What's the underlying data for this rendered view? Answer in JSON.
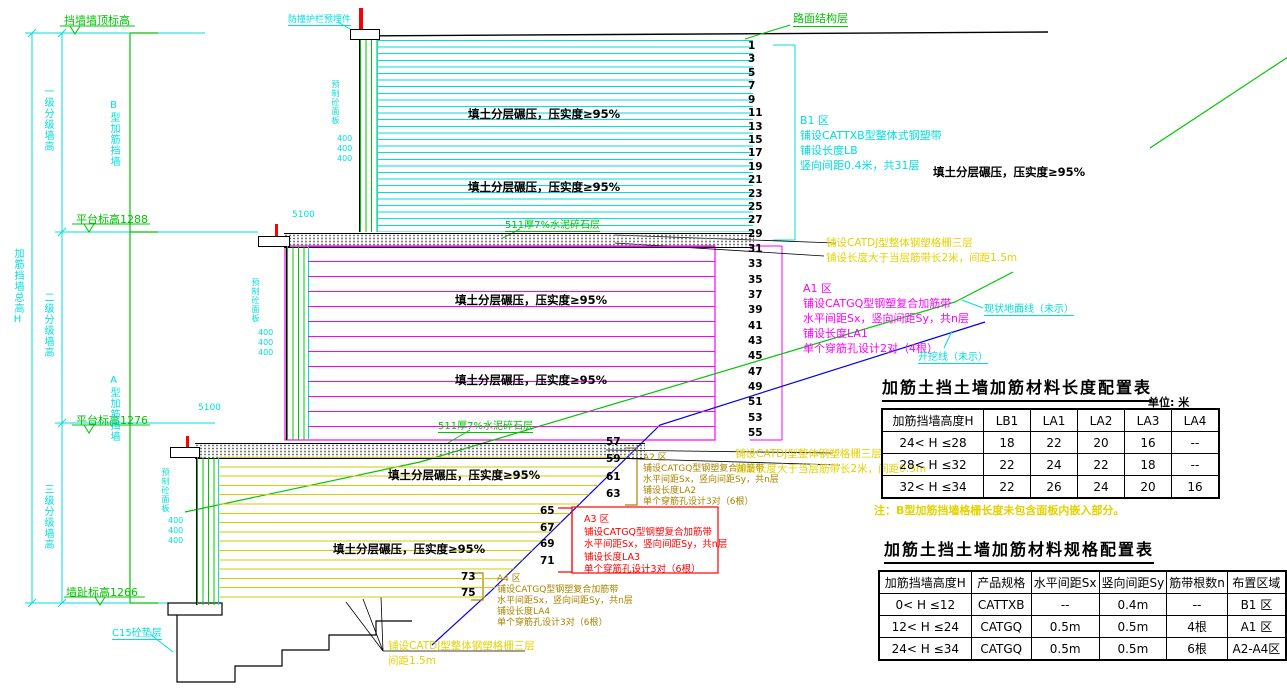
{
  "colors": {
    "cyan": "#00dede",
    "green": "#00c400",
    "magenta": "#ff00ff",
    "yellow": "#e3d200",
    "red": "#ff0000",
    "olive": "#a88400",
    "blue": "#0000ee",
    "black": "#000000",
    "tier3_line": "#d8ca00",
    "background": "#ffffff"
  },
  "elevations": {
    "top": "挡墙墙顶标高",
    "p1288": "平台标高1288",
    "p1276": "平台标高1276",
    "toe": "墙趾标高1266"
  },
  "dims": {
    "total": "加筋挡墙总高H",
    "tier1": "一级分级墙高",
    "tier2": "二级分级墙高",
    "tier3": "三级分级墙高",
    "type_b": "B型加筋挡墙",
    "type_a": "A型加筋挡墙",
    "panel_dim": "400",
    "berm_dim": "5100"
  },
  "labels": {
    "road": "路面结构层",
    "barrier": "防撞护栏预埋件",
    "panel": "预制砼面板",
    "cushion": "511厚7%水泥碎石层",
    "fill": "填土分层碾压，压实度≥95%",
    "ground_line": "现状地面线（未示）",
    "excavation_line": "开挖线（未示）",
    "footing": "C15砼垫层"
  },
  "zones": {
    "b1": [
      "B1 区",
      "铺设CATTXB型整体式钢塑带",
      "铺设长度LB",
      "竖向间距0.4米，共31层"
    ],
    "a1": [
      "A1 区",
      "铺设CATGQ型钢塑复合加筋带",
      "水平间距Sx，竖向间距Sy，共n层",
      "铺设长度LA1",
      "单个穿筋孔设计2对（4根）"
    ],
    "a2": [
      "A2 区",
      "铺设CATGQ型钢塑复合加筋带",
      "水平间距Sx，竖向间距Sy，共n层",
      "铺设长度LA2",
      "单个穿筋孔设计3对（6根）"
    ],
    "a3": [
      "A3 区",
      "铺设CATGQ型钢塑复合加筋带",
      "水平间距Sx，竖向间距Sy，共n层",
      "铺设长度LA3",
      "单个穿筋孔设计3对（6根）"
    ],
    "a4": [
      "A4 区",
      "铺设CATGQ型钢塑复合加筋带",
      "水平间距Sx，竖向间距Sy，共n层",
      "铺设长度LA4",
      "单个穿筋孔设计3对（6根）"
    ]
  },
  "notes": {
    "interface1": [
      "铺设CATDJ型整体钢塑格栅三层",
      "铺设长度大于当层筋带长2米，间距1.5m"
    ],
    "interface2": [
      "铺设CATDJ型整体钢塑格栅三层",
      "铺设长度大于当层筋带长2米，间距0.5m"
    ],
    "footing_note": [
      "铺设CATDJ型整体钢塑格栅三层",
      "间距1.5m"
    ]
  },
  "layers": {
    "tier1": [
      "1",
      "3",
      "5",
      "7",
      "9",
      "11",
      "13",
      "15",
      "17",
      "19",
      "21",
      "23",
      "25",
      "27",
      "29"
    ],
    "tier2": [
      "31",
      "33",
      "35",
      "37",
      "39",
      "41",
      "43",
      "45",
      "47",
      "49",
      "51",
      "53",
      "55"
    ],
    "a2": [
      "57",
      "59",
      "61",
      "63"
    ],
    "a3": [
      "65",
      "67",
      "69",
      "71"
    ],
    "a4": [
      "73",
      "75"
    ]
  },
  "tables": [
    {
      "title": "加筋土挡土墙加筋材料长度配置表",
      "unit": "单位: 米",
      "headers": [
        "加筋挡墙高度H",
        "LB1",
        "LA1",
        "LA2",
        "LA3",
        "LA4"
      ],
      "rows": [
        [
          "24< H ≤28",
          "18",
          "22",
          "20",
          "16",
          "--"
        ],
        [
          "28< H ≤32",
          "22",
          "24",
          "22",
          "18",
          "--"
        ],
        [
          "32< H ≤34",
          "22",
          "26",
          "24",
          "20",
          "16"
        ]
      ],
      "note": "注：B型加筋挡墙格栅长度未包含面板内嵌入部分。"
    },
    {
      "title": "加筋土挡土墙加筋材料规格配置表",
      "unit": "",
      "headers": [
        "加筋挡墙高度H",
        "产品规格",
        "水平间距Sx",
        "竖向间距Sy",
        "筋带根数n",
        "布置区域"
      ],
      "rows": [
        [
          "0< H ≤12",
          "CATTXB",
          "--",
          "0.4m",
          "--",
          "B1 区"
        ],
        [
          "12< H ≤24",
          "CATGQ",
          "0.5m",
          "0.5m",
          "4根",
          "A1 区"
        ],
        [
          "24< H ≤34",
          "CATGQ",
          "0.5m",
          "0.5m",
          "6根",
          "A2-A4区"
        ]
      ],
      "note": ""
    }
  ]
}
